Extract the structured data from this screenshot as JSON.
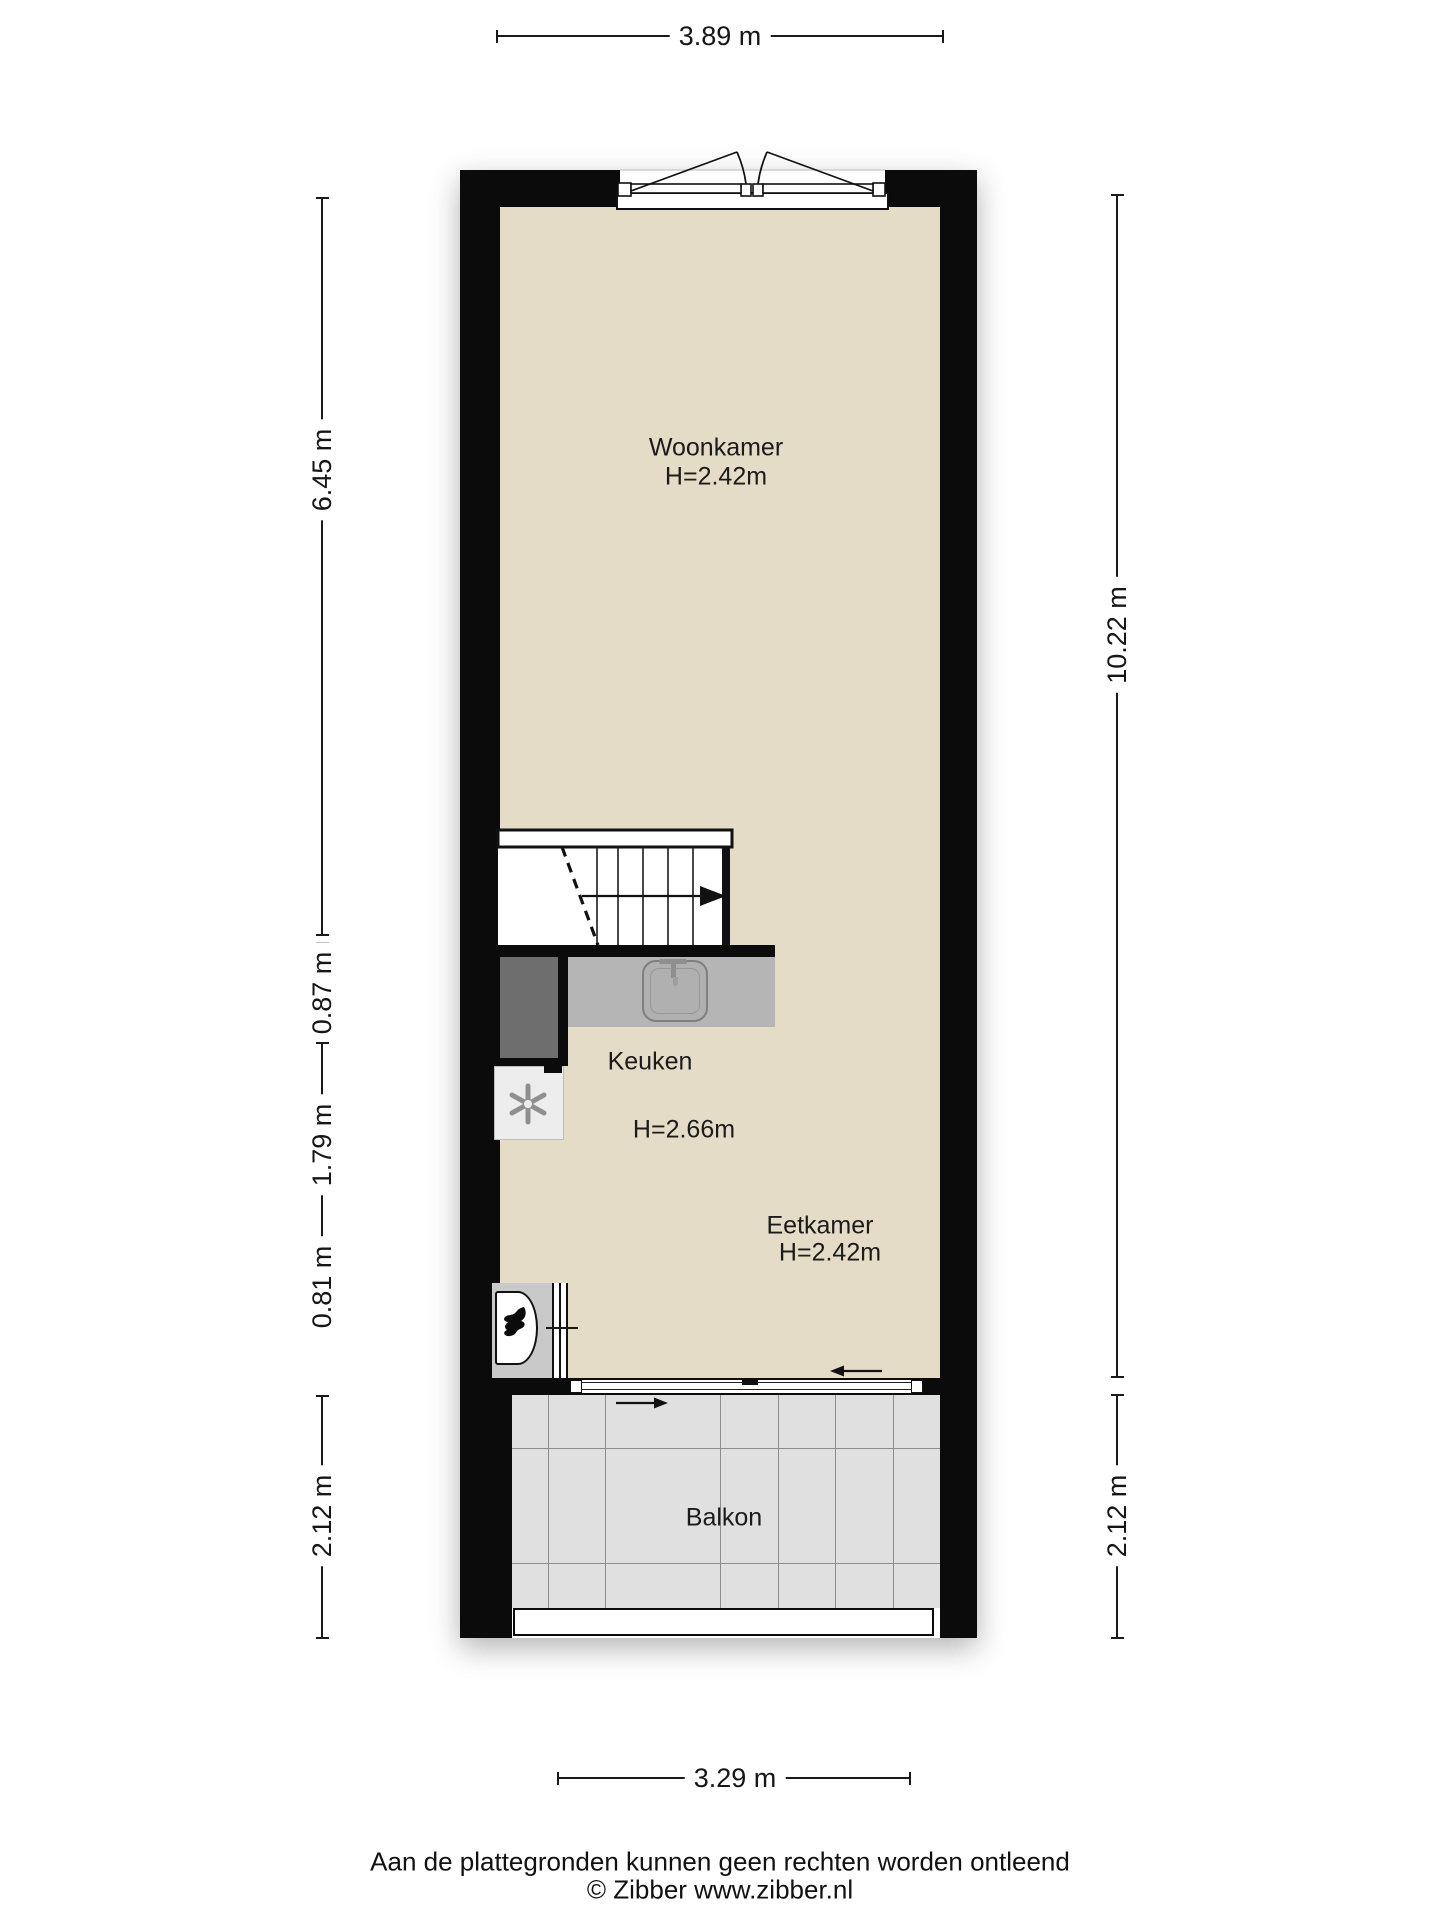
{
  "plan": {
    "rooms": [
      {
        "name": "Woonkamer",
        "height": "H=2.42m"
      },
      {
        "name": "Keuken",
        "height": "H=2.66m"
      },
      {
        "name": "Eetkamer",
        "height": "H=2.42m"
      },
      {
        "name": "Balkon",
        "height": ""
      }
    ],
    "dims": {
      "top": "3.89 m",
      "bottom": "3.29 m",
      "left_segments": [
        "6.45 m",
        "0.87 m",
        "1.79 m",
        "0.81 m",
        "2.12 m"
      ],
      "right_segments": [
        "10.22 m",
        "2.12 m"
      ]
    },
    "icons": [
      "stairs-up-arrow",
      "door-swing-arcs",
      "kitchen-sink",
      "faucet",
      "ventilation-asterisk",
      "fireplace-flame",
      "slide-direction-arrow"
    ],
    "colors": {
      "wall": "#0b0b0b",
      "floor": "#e4dcc6",
      "counter": "#b5b5b5",
      "balcony_tile": "#e0e0e0",
      "shaft": "#6e6e6e",
      "dimension_text": "#161616"
    }
  },
  "footer": {
    "disclaimer": "Aan de plattegronden kunnen geen rechten worden ontleend",
    "credit": "© Zibber www.zibber.nl"
  }
}
